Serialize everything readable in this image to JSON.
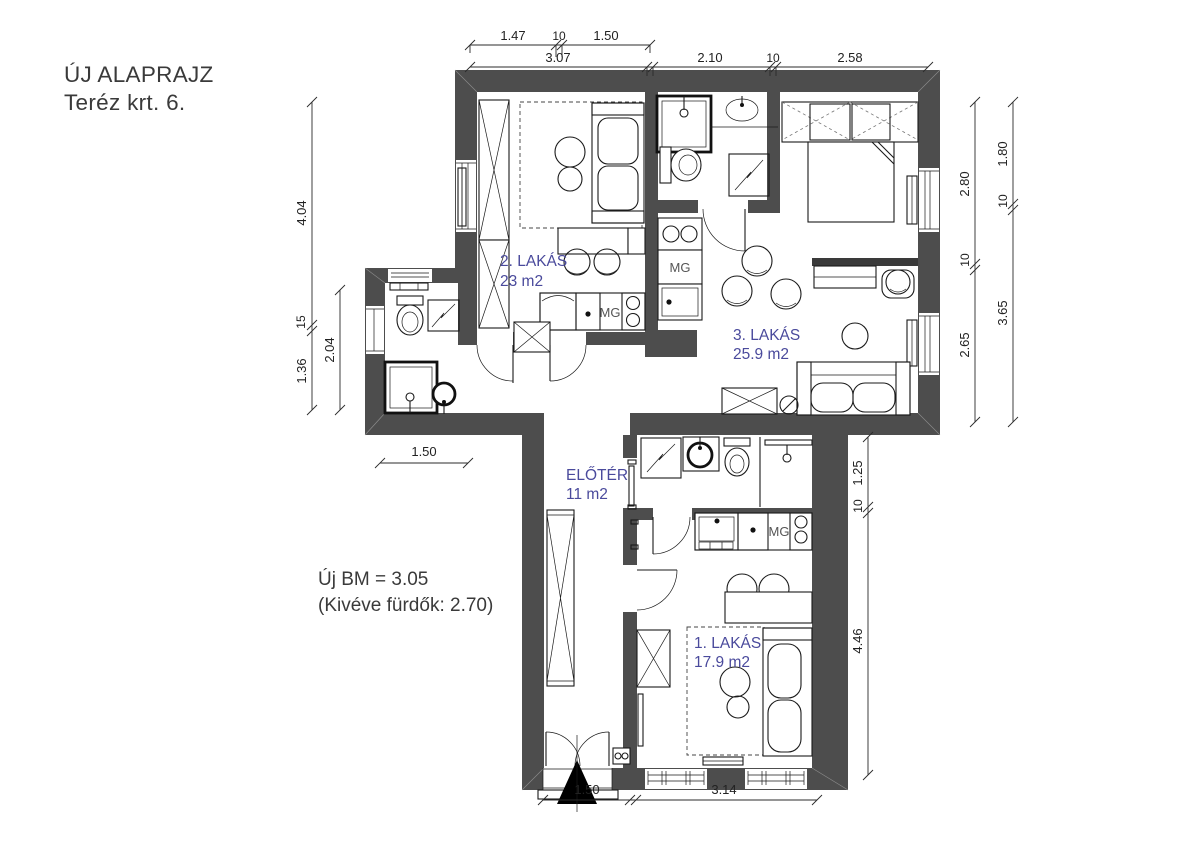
{
  "title": {
    "line1": "ÚJ ALAPRAJZ",
    "line2": "Teréz krt. 6."
  },
  "note": {
    "line1": "Új BM = 3.05",
    "line2": "(Kivéve fürdők: 2.70)"
  },
  "rooms": {
    "lakas2": {
      "name": "2. LAKÁS",
      "area": "23 m2"
    },
    "lakas3": {
      "name": "3. LAKÁS",
      "area": "25.9 m2"
    },
    "eloter": {
      "name": "ELŐTÉR",
      "area": "11 m2"
    },
    "lakas1": {
      "name": "1. LAKÁS",
      "area": "17.9 m2"
    }
  },
  "labels": {
    "washing_machine": "MG"
  },
  "dimensions": {
    "top_sub": {
      "d1": "1.47",
      "d2": "10",
      "d3": "1.50"
    },
    "top_main": {
      "d1": "3.07",
      "d2": "2.10",
      "d3": "10",
      "d4": "2.58"
    },
    "left_outer": {
      "d1": "4.04",
      "d2": "15",
      "d3": "1.36"
    },
    "left_inner": {
      "d1": "2.04"
    },
    "right_inner": {
      "d1": "2.80",
      "d2": "10",
      "d3": "2.65"
    },
    "right_outer": {
      "d1": "1.80",
      "d2": "10",
      "d3": "3.65"
    },
    "stem_right": {
      "d1": "1.25",
      "d2": "10",
      "d3": "4.46"
    },
    "bottom": {
      "d1": "1.50",
      "d2": "3.14"
    },
    "annex_bottom": {
      "d1": "1.50"
    }
  },
  "colors": {
    "wall": "#4d4d4d",
    "room_label": "#4a4a9c",
    "line": "#1a1a1a",
    "background": "#ffffff"
  }
}
